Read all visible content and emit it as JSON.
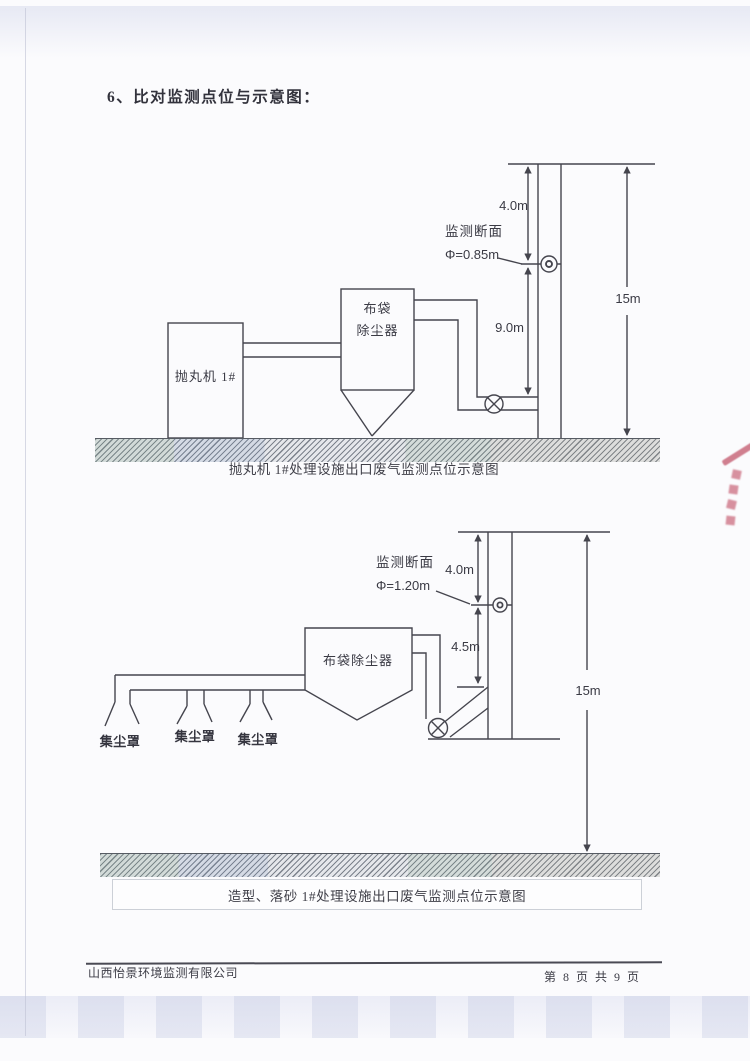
{
  "page": {
    "heading": "6、比对监测点位与示意图：",
    "footer": {
      "company": "山西怡景环境监测有限公司",
      "page_info": "第 8 页 共 9 页"
    },
    "stamp_color": "#c2566b"
  },
  "diagram1": {
    "caption": "抛丸机 1#处理设施出口废气监测点位示意图",
    "machine_label": "抛丸机 1#",
    "collector_line1": "布袋",
    "collector_line2": "除尘器",
    "monitor_label": "监测断面",
    "diameter_label": "Φ=0.85m",
    "dim_top": "4.0m",
    "dim_mid": "9.0m",
    "dim_total": "15m"
  },
  "diagram2": {
    "caption": "造型、落砂 1#处理设施出口废气监测点位示意图",
    "collector_label": "布袋除尘器",
    "hood_labels": [
      "集尘罩",
      "集尘罩",
      "集尘罩"
    ],
    "monitor_label": "监测断面",
    "diameter_label": "Φ=1.20m",
    "dim_top": "4.0m",
    "dim_mid": "4.5m",
    "dim_total": "15m"
  }
}
